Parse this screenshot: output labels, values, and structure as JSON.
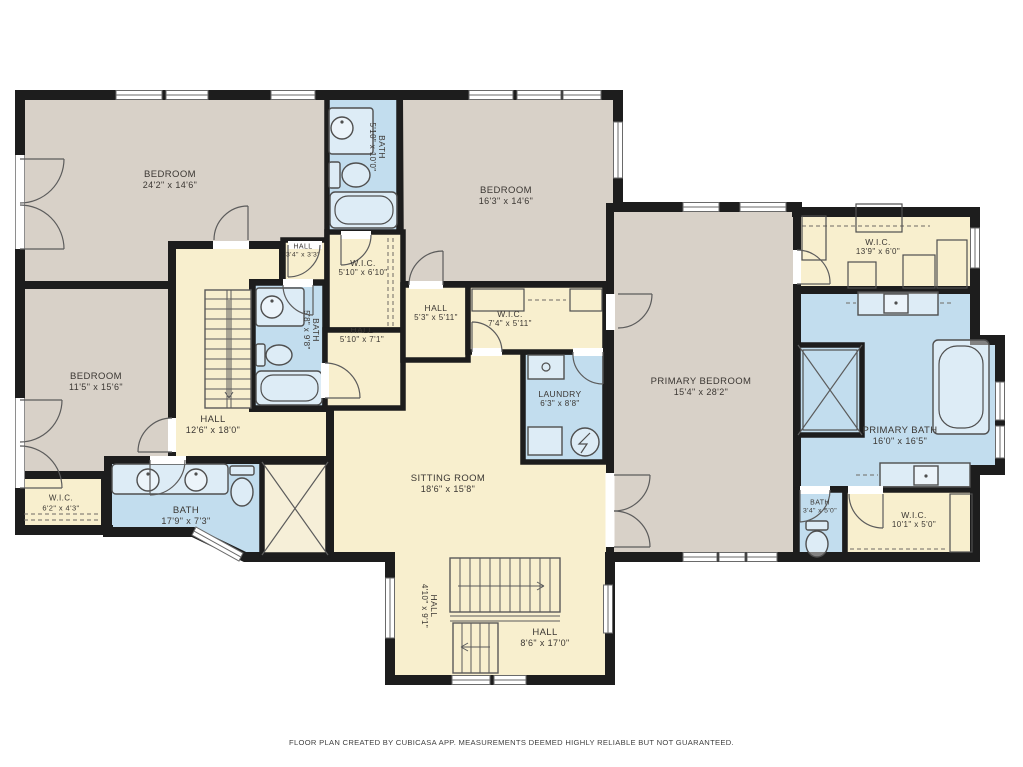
{
  "colors": {
    "wall": "#1d1d1d",
    "taupe": "#d8d1c8",
    "beige": "#f8efce",
    "blue": "#c2ddee",
    "cream": "#f6efd8",
    "fx": "#4f4f4f",
    "thin": "#5c5c5c",
    "text": "#3b3733"
  },
  "rooms": {
    "bedroom_tl": {
      "name": "BEDROOM",
      "dims": "24'2\" x 14'6\""
    },
    "bath_top": {
      "name": "BATH",
      "dims": "5'10\" x 10'0\""
    },
    "bedroom_tr": {
      "name": "BEDROOM",
      "dims": "16'3\" x 14'6\""
    },
    "hall_small": {
      "name": "HALL",
      "dims": "3'4\" x 3'3\""
    },
    "wic_center": {
      "name": "W.I.C.",
      "dims": "5'10\" x 6'10\""
    },
    "bath_center": {
      "name": "BATH",
      "dims": "5'8\" x 9'8\""
    },
    "hall_center_a": {
      "name": "HALL",
      "dims": "5'10\" x 7'1\""
    },
    "hall_center_b": {
      "name": "HALL",
      "dims": "5'3\" x 5'11\""
    },
    "wic_center_b": {
      "name": "W.I.C.",
      "dims": "7'4\" x 5'11\""
    },
    "laundry": {
      "name": "LAUNDRY",
      "dims": "6'3\" x 8'8\""
    },
    "bedroom_left": {
      "name": "BEDROOM",
      "dims": "11'5\" x 15'6\""
    },
    "hall_left": {
      "name": "HALL",
      "dims": "12'6\" x 18'0\""
    },
    "wic_left": {
      "name": "W.I.C.",
      "dims": "6'2\" x 4'3\""
    },
    "bath_left": {
      "name": "BATH",
      "dims": "17'9\" x 7'3\""
    },
    "sitting_room": {
      "name": "SITTING ROOM",
      "dims": "18'6\" x 15'8\""
    },
    "hall_bottom_v": {
      "name": "HALL",
      "dims": "4'10\" x 9'1\""
    },
    "hall_bottom": {
      "name": "HALL",
      "dims": "8'6\" x 17'0\""
    },
    "primary_bedroom": {
      "name": "PRIMARY BEDROOM",
      "dims": "15'4\" x 28'2\""
    },
    "wic_primary_top": {
      "name": "W.I.C.",
      "dims": "13'9\" x 6'0\""
    },
    "primary_bath": {
      "name": "PRIMARY BATH",
      "dims": "16'0\" x 16'5\""
    },
    "bath_small": {
      "name": "BATH",
      "dims": "3'4\" x 5'0\""
    },
    "wic_primary_bottom": {
      "name": "W.I.C.",
      "dims": "10'1\" x 5'0\""
    }
  },
  "footer": {
    "text": "FLOOR PLAN CREATED BY CUBICASA APP. MEASUREMENTS DEEMED HIGHLY RELIABLE BUT NOT GUARANTEED."
  }
}
